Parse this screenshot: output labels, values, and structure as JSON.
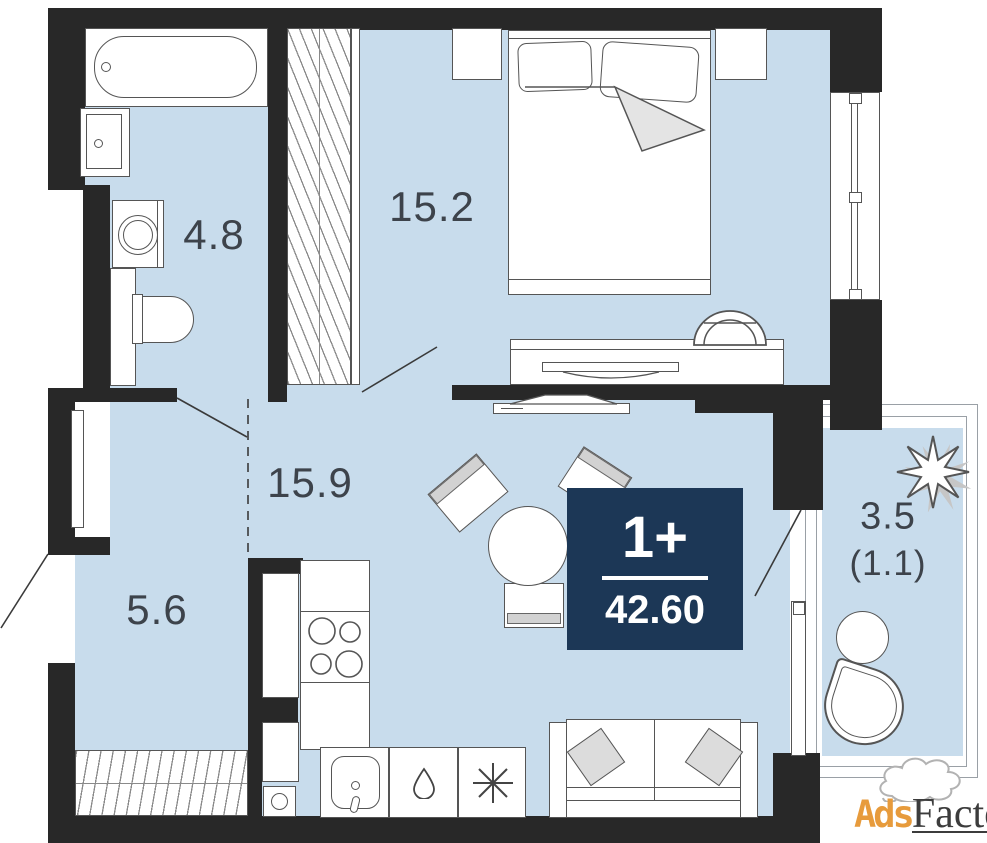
{
  "plan": {
    "type": "apartment-floor-plan",
    "colors": {
      "floor": "#c8dcec",
      "wall": "#282828",
      "outline": "#555555",
      "badge": "#1c3756",
      "label": "#3d434b",
      "orange": "#e79b3c"
    },
    "rooms": {
      "bathroom": {
        "label": "4.8"
      },
      "bedroom": {
        "label": "15.2"
      },
      "hall": {
        "label": "15.9"
      },
      "room2": {
        "label": "5.6"
      },
      "balcony": {
        "label": "3.5",
        "label_secondary": "(1.1)"
      }
    },
    "badge": {
      "layout": "1+",
      "area": "42.60"
    },
    "watermark": {
      "prefix": "Ads",
      "suffix": "Factory"
    },
    "icons": [
      "bathtub-icon",
      "bathroom-sink-icon",
      "washing-machine-icon",
      "toilet-icon",
      "wardrobe-hatch-icon",
      "bed-icon",
      "nightstand-icon",
      "desk-icon",
      "desk-chair-icon",
      "tv-icon",
      "dining-table-icon",
      "dining-chair-icon",
      "sofa-icon",
      "stove-burners-icon",
      "kitchen-sink-icon",
      "dishwasher-drop-icon",
      "fridge-snowflake-icon",
      "plant-icon",
      "balcony-table-icon",
      "balcony-chair-icon",
      "door-leaf-icon",
      "window-icon",
      "smoke-icon"
    ]
  }
}
